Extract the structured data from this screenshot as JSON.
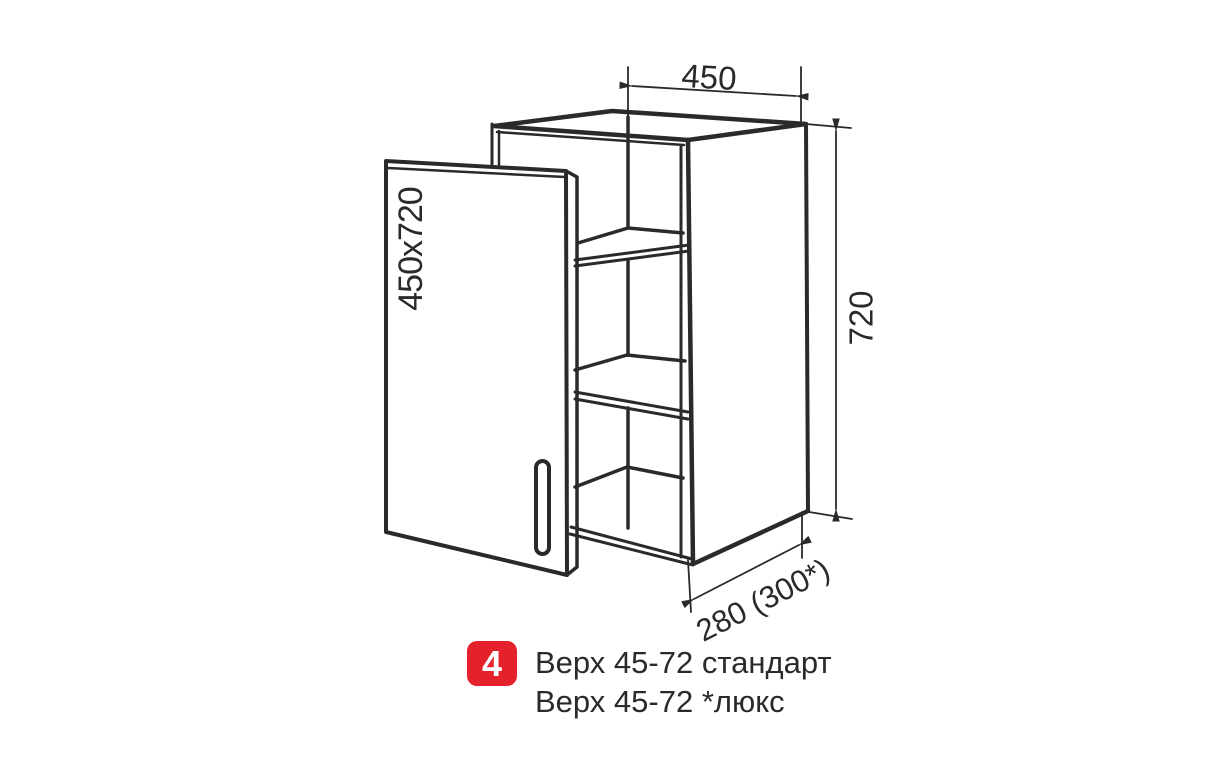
{
  "meta": {
    "background_color": "#ffffff",
    "line_color": "#2b2a29",
    "accent_red": "#e5212b"
  },
  "diagram": {
    "kind": "kitchen wall cabinet, axonometric line drawing with open door and 3 shelves",
    "door_label": "450x720",
    "width_dim": "450",
    "height_dim": "720",
    "depth_dim": "280 (300*)"
  },
  "caption": {
    "number": "4",
    "line1": "Верх 45-72 стандарт",
    "line2": "Верх 45-72 *люкс"
  }
}
